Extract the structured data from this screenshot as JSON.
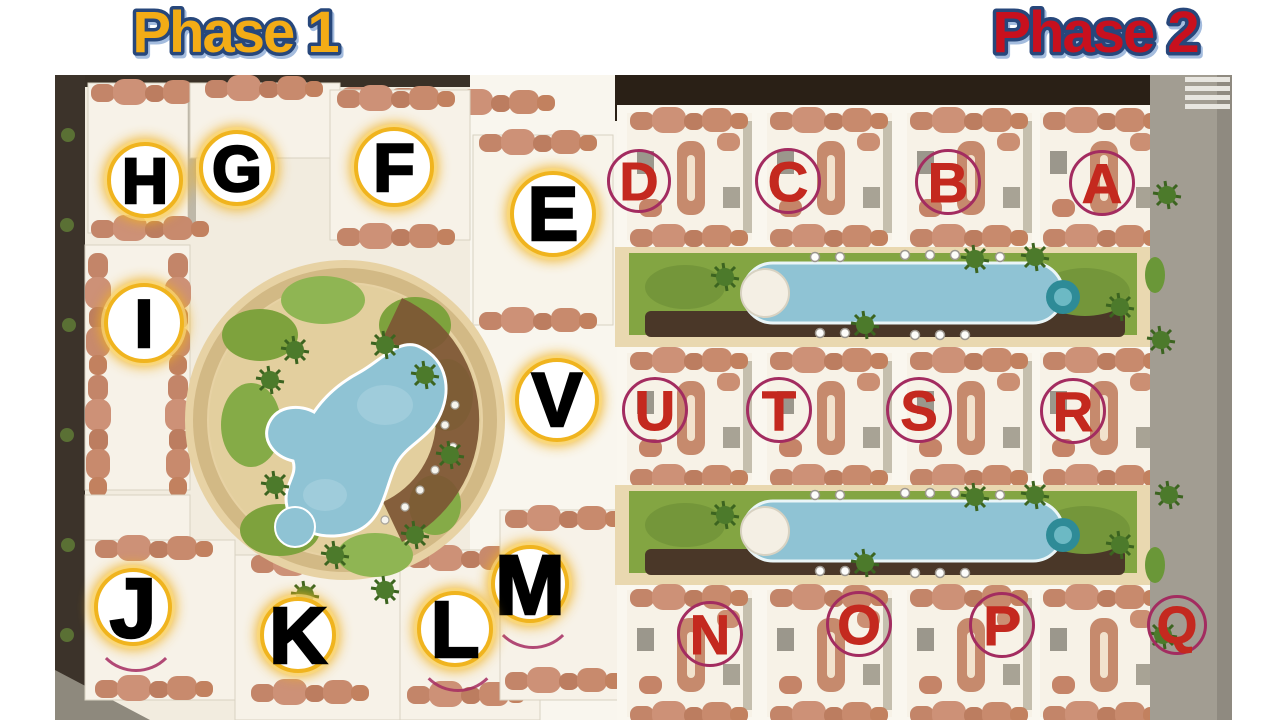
{
  "page": {
    "background": "#ffffff"
  },
  "phase1": {
    "title": "Phase 1",
    "title_color": "#F3AC16",
    "title_outline_color": "#27477B",
    "marker_style": {
      "ring": "#F0B41E",
      "fill": "#FFFFFF",
      "letter_color": "#000000"
    },
    "markers": [
      {
        "letter": "H",
        "x": 145,
        "y": 180,
        "r": 38,
        "font": 64
      },
      {
        "letter": "G",
        "x": 237,
        "y": 168,
        "r": 38,
        "font": 64
      },
      {
        "letter": "F",
        "x": 394,
        "y": 167,
        "r": 40,
        "font": 68
      },
      {
        "letter": "E",
        "x": 553,
        "y": 214,
        "r": 43,
        "font": 76
      },
      {
        "letter": "I",
        "x": 144,
        "y": 323,
        "r": 40,
        "font": 68
      },
      {
        "letter": "V",
        "x": 557,
        "y": 400,
        "r": 42,
        "font": 76
      },
      {
        "letter": "M",
        "x": 530,
        "y": 584,
        "r": 39,
        "font": 84,
        "arc": true
      },
      {
        "letter": "J",
        "x": 133,
        "y": 607,
        "r": 39,
        "font": 84,
        "arc": true
      },
      {
        "letter": "K",
        "x": 298,
        "y": 635,
        "r": 38,
        "font": 80
      },
      {
        "letter": "L",
        "x": 455,
        "y": 629,
        "r": 38,
        "font": 80,
        "arc": true
      }
    ]
  },
  "phase2": {
    "title": "Phase 2",
    "title_color": "#C8101E",
    "title_outline_color": "#27477B",
    "marker_style": {
      "ring": "#A32C60",
      "fill": "transparent",
      "letter_color": "#C4291F"
    },
    "markers": [
      {
        "letter": "D",
        "x": 639,
        "y": 181,
        "r": 32,
        "font": 54
      },
      {
        "letter": "C",
        "x": 788,
        "y": 181,
        "r": 33,
        "font": 56
      },
      {
        "letter": "B",
        "x": 948,
        "y": 182,
        "r": 33,
        "font": 56
      },
      {
        "letter": "A",
        "x": 1102,
        "y": 183,
        "r": 33,
        "font": 56
      },
      {
        "letter": "U",
        "x": 655,
        "y": 410,
        "r": 33,
        "font": 56
      },
      {
        "letter": "T",
        "x": 779,
        "y": 410,
        "r": 33,
        "font": 56
      },
      {
        "letter": "S",
        "x": 919,
        "y": 410,
        "r": 33,
        "font": 56
      },
      {
        "letter": "R",
        "x": 1073,
        "y": 411,
        "r": 33,
        "font": 56
      },
      {
        "letter": "N",
        "x": 710,
        "y": 634,
        "r": 33,
        "font": 56
      },
      {
        "letter": "O",
        "x": 859,
        "y": 624,
        "r": 33,
        "font": 56
      },
      {
        "letter": "P",
        "x": 1002,
        "y": 625,
        "r": 33,
        "font": 56
      },
      {
        "letter": "Q",
        "x": 1177,
        "y": 625,
        "r": 30,
        "font": 52
      }
    ]
  },
  "map_palette": {
    "ground": "#f2ecdf",
    "road_white": "#f9f6ee",
    "terracotta_roof": "#c88a6d",
    "pool_blue": "#8fc3d4",
    "jacuzzi_teal": "#2e8b97",
    "lawn_green": "#83a542",
    "deck_brown": "#7d5634",
    "walkway_dark_brown": "#4a3728",
    "perimeter_dark": "#3a3127",
    "street_gray": "#a29d92"
  }
}
